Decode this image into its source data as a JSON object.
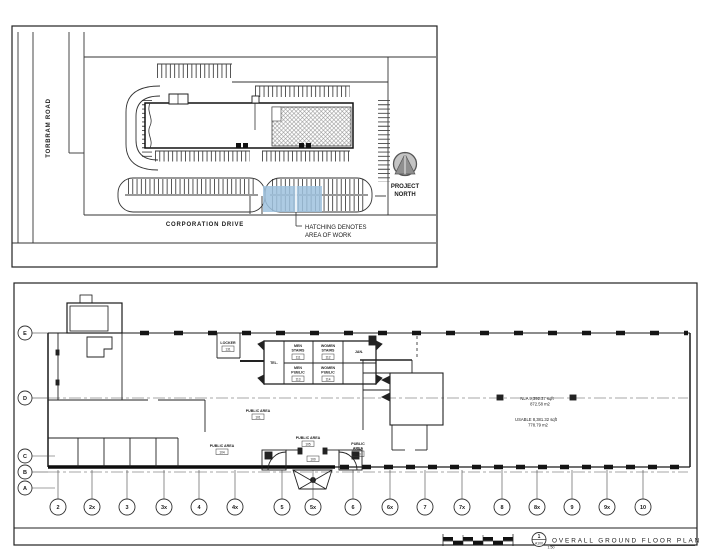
{
  "site_plan": {
    "road_vertical_label": "TORBRAM ROAD",
    "road_horizontal_label": "CORPORATION DRIVE",
    "work_note_line1": "HATCHING DENOTES",
    "work_note_line2": "AREA OF WORK",
    "north_label_line1": "PROJECT",
    "north_label_line2": "NORTH",
    "work_area_highlight_color": "#9fc2de"
  },
  "floor_plan": {
    "row_labels": [
      "E",
      "D",
      "C",
      "B",
      "A"
    ],
    "col_labels": [
      "2",
      "2x",
      "3",
      "3x",
      "4",
      "4x",
      "5",
      "5x",
      "6",
      "6x",
      "7",
      "7x",
      "8",
      "8x",
      "9",
      "9x",
      "10"
    ],
    "rooms": {
      "locker_name": "LOCKER",
      "locker_tag": "131",
      "men_stairs_line1": "MEN",
      "men_stairs_line2": "STAIRS",
      "men_stairs_tag": "111",
      "women_stairs_line1": "WOMEN",
      "women_stairs_line2": "STAIRS",
      "women_stairs_tag": "112",
      "men_public_line1": "MEN",
      "men_public_line2": "PUBLIC",
      "men_public_tag": "113",
      "women_public_line1": "WOMEN",
      "women_public_line2": "PUBLIC",
      "women_public_tag": "114",
      "tel_name": "TEL.",
      "jan_name": "JAN.",
      "public_area_1_name": "PUBLIC AREA",
      "public_area_1_tag": "101",
      "public_area_2_name": "PUBLIC AREA",
      "public_area_2_tag": "104",
      "public_area_3_name": "PUBLIC AREA",
      "public_area_3_tag": "105",
      "public_area_4_line1": "PUBLIC",
      "public_area_4_line2": "AREA",
      "public_area_4_tag": "103",
      "vestibule_tag": "100"
    },
    "area_summary": {
      "nla_line1": "NLA  9,392.37 sqft",
      "nla_line2": "872.58 m2",
      "usable_line1": "USABLE  8,381.32 sqft",
      "usable_line2": "778.79 m2"
    },
    "title_block": {
      "detail_number": "1",
      "sheet_number": "A100",
      "scale": "1:50",
      "title": "OVERALL GROUND FLOOR PLAN"
    }
  }
}
